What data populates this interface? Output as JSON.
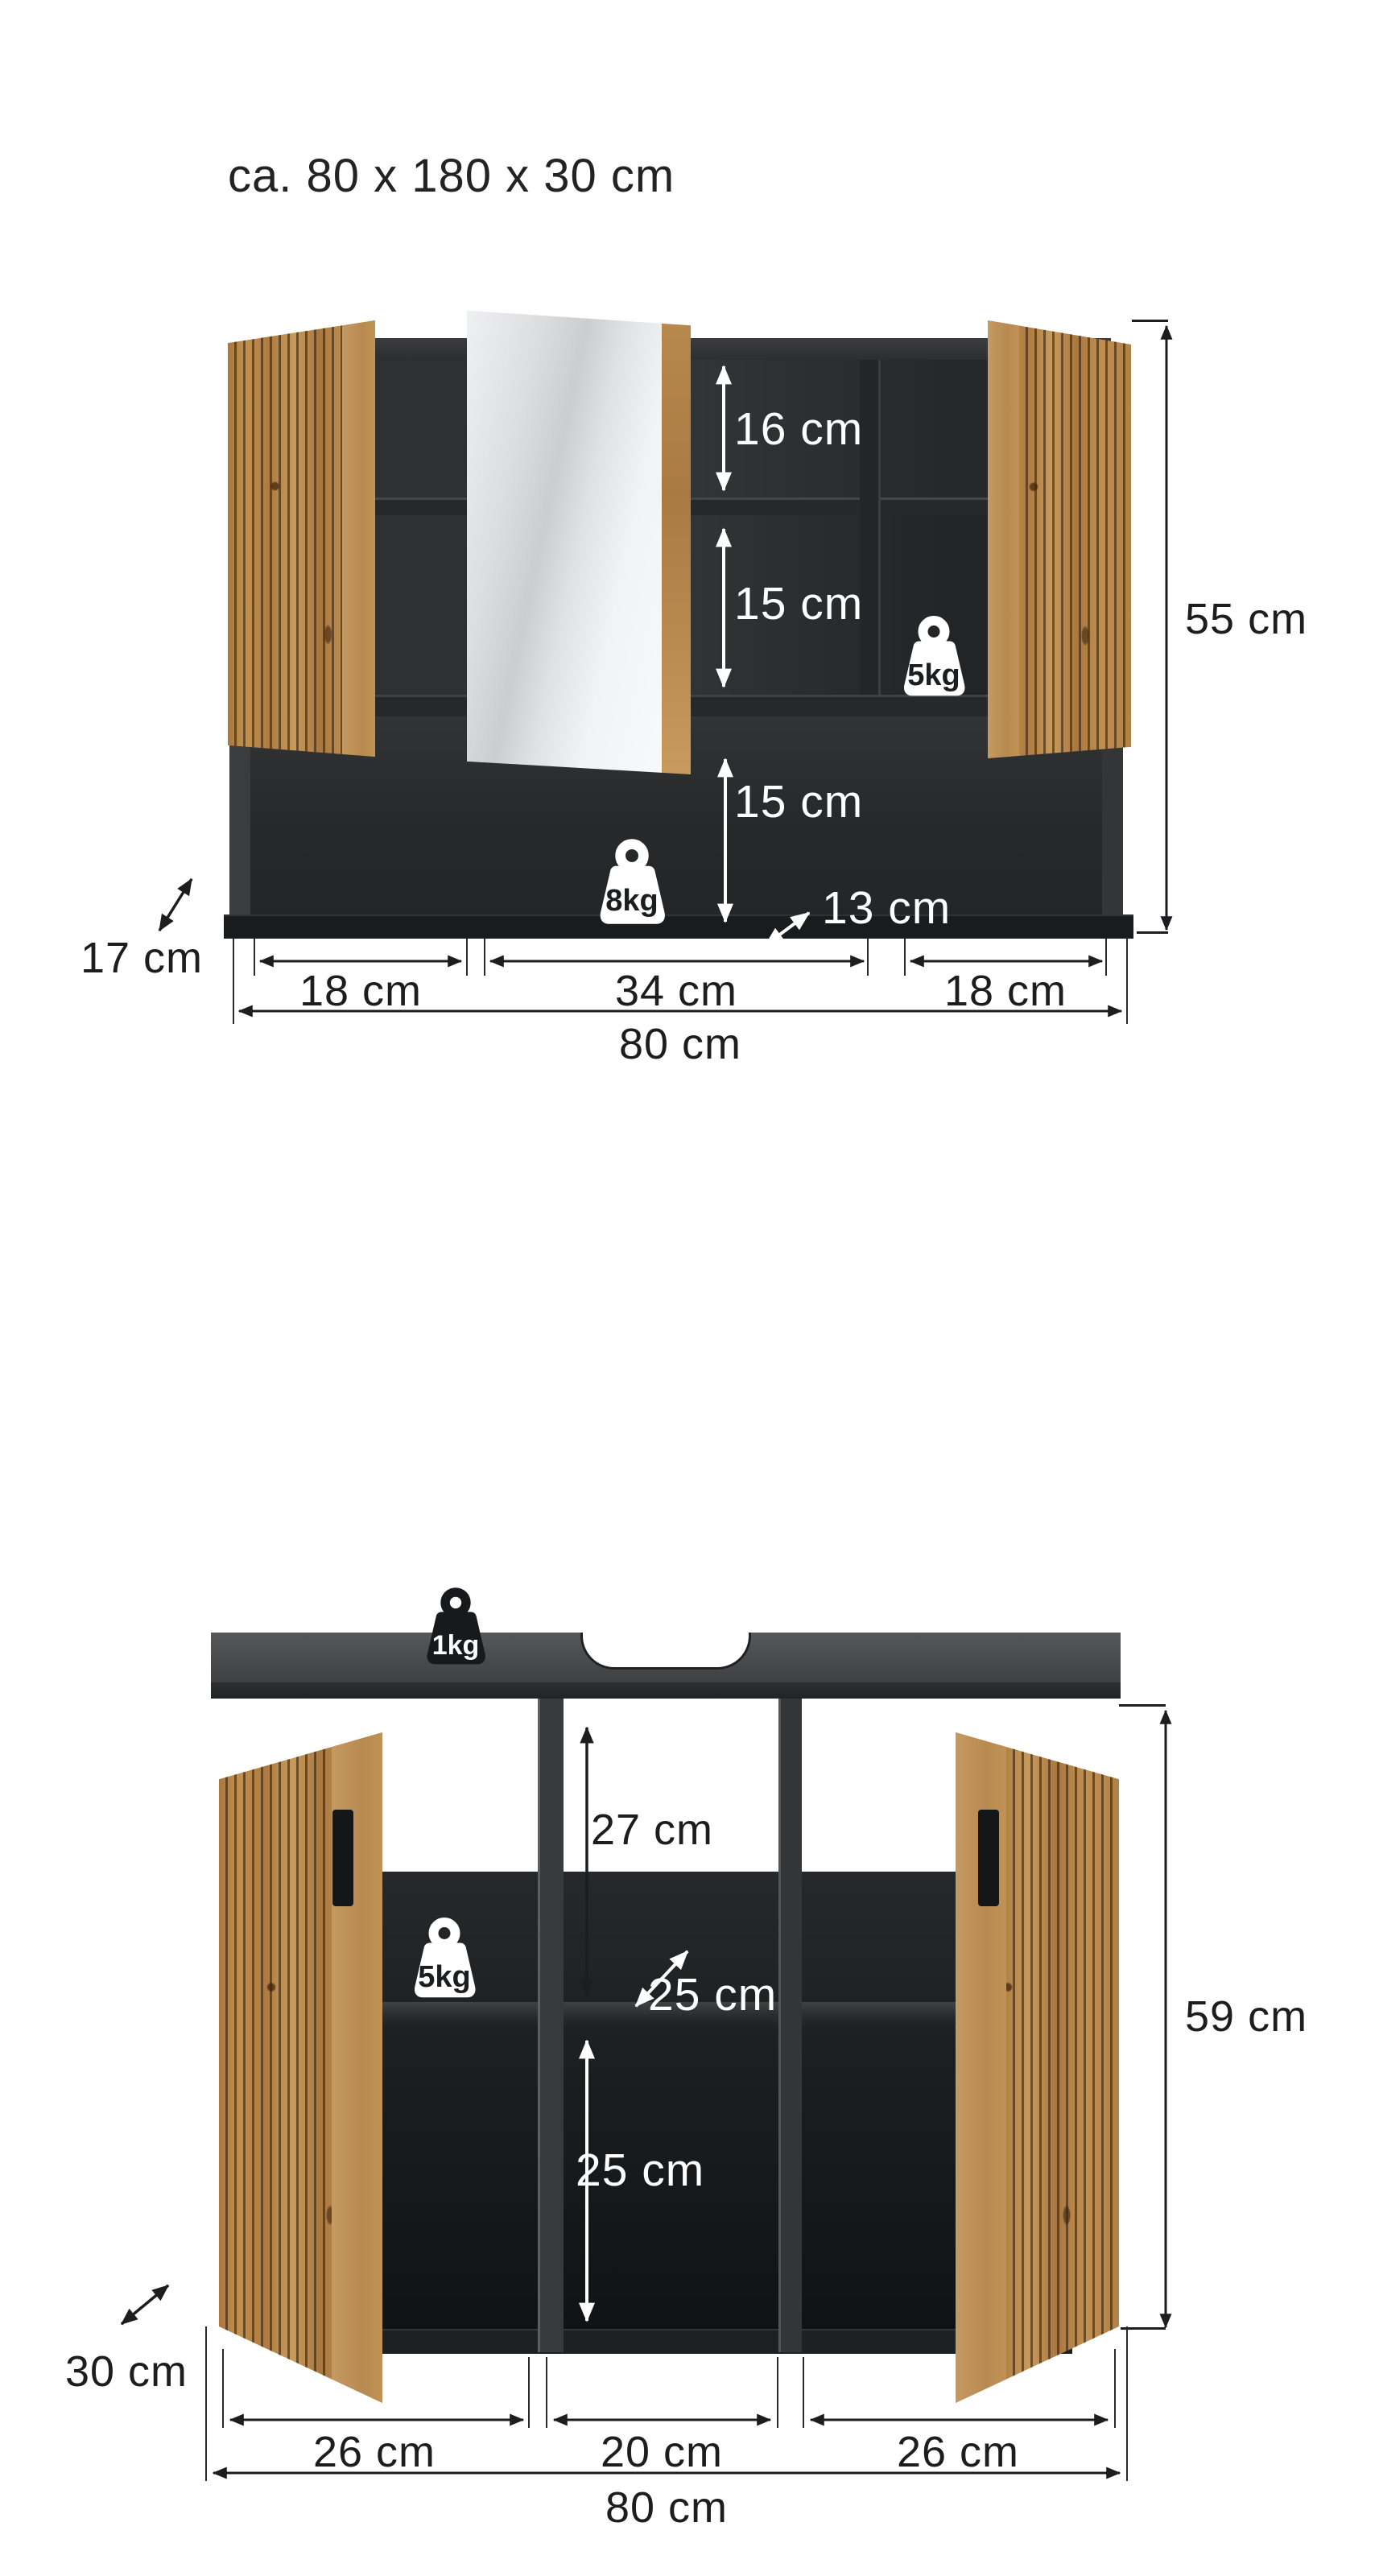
{
  "title": "ca. 80 x 180 x 30 cm",
  "top_cabinet": {
    "compartments": {
      "top": "16 cm",
      "middle": "15 cm",
      "bottom": "15 cm",
      "niche_depth": "13 cm"
    },
    "loads": {
      "shelf": "5kg",
      "bottom": "8kg"
    },
    "dims": {
      "height": "55 cm",
      "depth": "17 cm",
      "width_left": "18 cm",
      "width_middle": "34 cm",
      "width_right": "18 cm",
      "width_total": "80 cm"
    }
  },
  "bottom_cabinet": {
    "compartments": {
      "top": "27 cm",
      "shelf_depth": "25 cm",
      "bottom": "25 cm"
    },
    "loads": {
      "top": "1kg",
      "shelf": "5kg"
    },
    "dims": {
      "height": "59 cm",
      "depth": "30 cm",
      "width_left": "26 cm",
      "width_middle": "20 cm",
      "width_right": "26 cm",
      "width_total": "80 cm"
    }
  },
  "colors": {
    "wood": "#b5834b",
    "carcass": "#2e3032",
    "interior_dark": "#17191b",
    "line": "#1d1d1f",
    "label_light": "#ffffff"
  }
}
